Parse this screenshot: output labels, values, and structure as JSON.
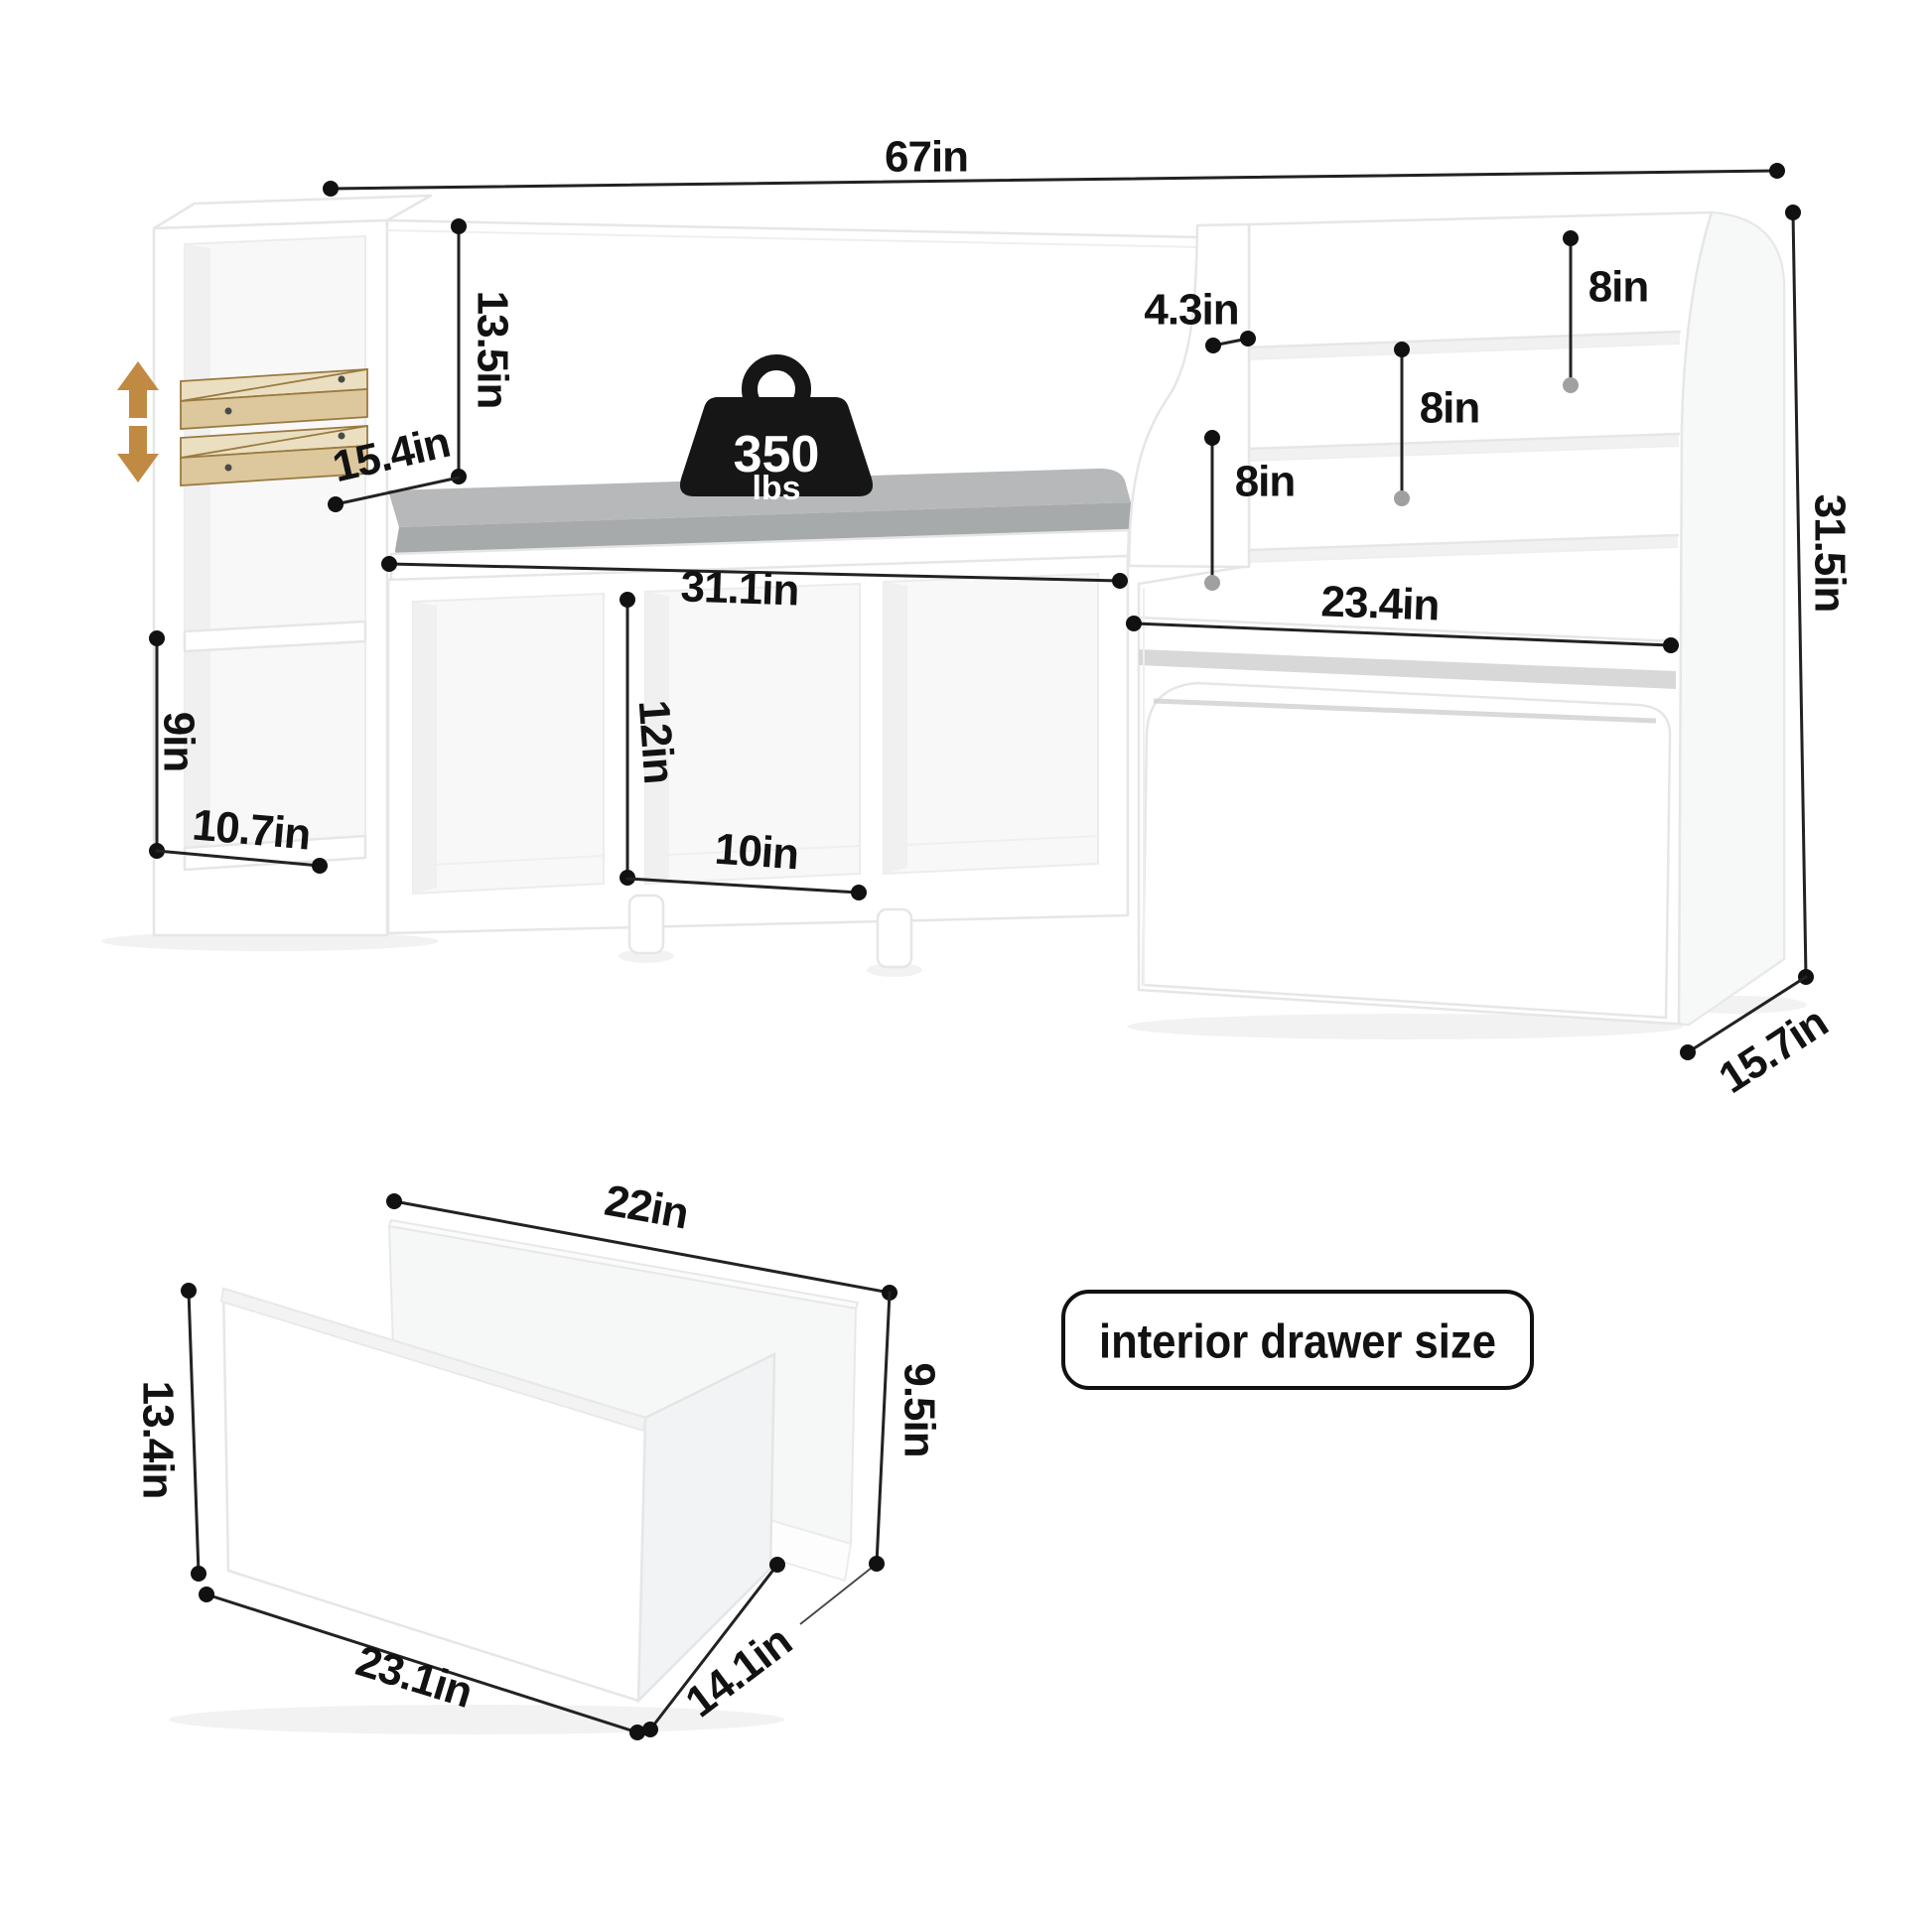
{
  "weight_capacity": {
    "value": "350",
    "unit": "lbs"
  },
  "callout": {
    "label": "interior drawer size"
  },
  "main_unit": {
    "overall_width": "67in",
    "back_height": "13.5in",
    "seat_depth": "15.4in",
    "bench_width": "31.1in",
    "cubby_height": "12in",
    "cubby_width": "10in",
    "side_shelf_height": "9in",
    "side_shelf_depth": "10.7in",
    "ledge_depth": "4.3in",
    "tier_gap_bottom": "8in",
    "tier_gap_middle": "8in",
    "tier_gap_top": "8in",
    "overall_height": "31.5in",
    "toybox_width": "23.4in",
    "overall_depth": "15.7in"
  },
  "drawer": {
    "interior_width": "22in",
    "front_height": "13.4in",
    "interior_height": "9.5in",
    "front_width": "23.1in",
    "depth": "14.1in"
  },
  "colors": {
    "dimension_line": "#222222",
    "dot": "#111111",
    "dot_muted": "#a0a0a0",
    "arrow": "#c08a43",
    "shelf_board": "#ebdfc1",
    "shelf_board_front": "#dcc89c",
    "shelf_board_edge": "#9a7a40",
    "cushion_top": "#b6b8b9",
    "cushion_front": "#a7aaab",
    "weight_icon": "#161616",
    "slot_shadow": "#d8d8d8"
  }
}
